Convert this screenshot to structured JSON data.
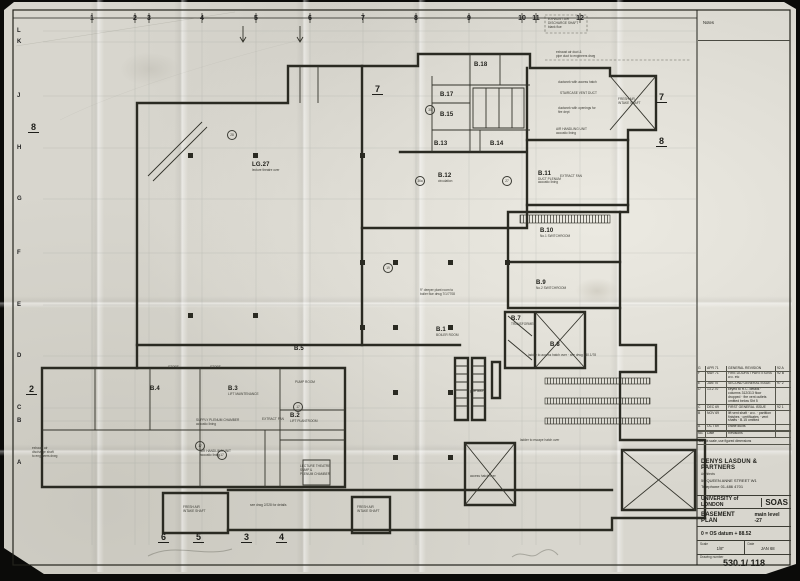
{
  "sheet": {
    "notes_label": "Notes",
    "do_not_scale": "Do not scale, use figured dimensions"
  },
  "grid": {
    "top_numbers": [
      {
        "label": "1",
        "x": 92
      },
      {
        "label": "2",
        "x": 135
      },
      {
        "label": "3",
        "x": 149
      },
      {
        "label": "4",
        "x": 202
      },
      {
        "label": "5",
        "x": 256
      },
      {
        "label": "6",
        "x": 310
      },
      {
        "label": "7",
        "x": 363
      },
      {
        "label": "8",
        "x": 416
      },
      {
        "label": "9",
        "x": 469
      },
      {
        "label": "10",
        "x": 522
      },
      {
        "label": "11",
        "x": 536
      },
      {
        "label": "12",
        "x": 580
      }
    ],
    "left_letters": [
      {
        "label": "L",
        "y": 31
      },
      {
        "label": "K",
        "y": 42
      },
      {
        "label": "J",
        "y": 96
      },
      {
        "label": "H",
        "y": 148
      },
      {
        "label": "G",
        "y": 199
      },
      {
        "label": "F",
        "y": 253
      },
      {
        "label": "E",
        "y": 305
      },
      {
        "label": "D",
        "y": 356
      },
      {
        "label": "C",
        "y": 408
      },
      {
        "label": "B",
        "y": 421
      },
      {
        "label": "A",
        "y": 463
      }
    ]
  },
  "section_markers": [
    {
      "t": "8",
      "x": 28,
      "y": 122
    },
    {
      "t": "2",
      "x": 26,
      "y": 384
    },
    {
      "t": "7",
      "x": 372,
      "y": 84
    },
    {
      "t": "7",
      "x": 656,
      "y": 92
    },
    {
      "t": "8",
      "x": 656,
      "y": 136
    },
    {
      "t": "6",
      "x": 158,
      "y": 532
    },
    {
      "t": "5",
      "x": 193,
      "y": 532
    },
    {
      "t": "3",
      "x": 241,
      "y": 532
    },
    {
      "t": "4",
      "x": 276,
      "y": 532
    }
  ],
  "rooms": [
    {
      "id": "LG.27",
      "sub": "lecture theatre over",
      "x": 252,
      "y": 162
    },
    {
      "id": "B.18",
      "sub": "",
      "x": 474,
      "y": 62
    },
    {
      "id": "B.17",
      "sub": "",
      "x": 440,
      "y": 92
    },
    {
      "id": "B.15",
      "sub": "",
      "x": 440,
      "y": 112
    },
    {
      "id": "B.13",
      "sub": "",
      "x": 434,
      "y": 141
    },
    {
      "id": "B.14",
      "sub": "",
      "x": 490,
      "y": 141
    },
    {
      "id": "B.12",
      "sub": "circulation",
      "x": 438,
      "y": 173
    },
    {
      "id": "B.11",
      "sub": "DUCT PLENUM\nacoustic lining",
      "x": 538,
      "y": 171
    },
    {
      "id": "B.10",
      "sub": "No.1 SWITCHROOM",
      "x": 540,
      "y": 228
    },
    {
      "id": "B.9",
      "sub": "No.2 SWITCHROOM",
      "x": 536,
      "y": 280
    },
    {
      "id": "B.7",
      "sub": "TRANSFORMER",
      "x": 511,
      "y": 316
    },
    {
      "id": "B.8",
      "sub": "",
      "x": 550,
      "y": 342
    },
    {
      "id": "B.5",
      "sub": "",
      "x": 294,
      "y": 346
    },
    {
      "id": "B.4",
      "sub": "",
      "x": 150,
      "y": 386
    },
    {
      "id": "B.3",
      "sub": "LIFT MAINTENANCE",
      "x": 228,
      "y": 386
    },
    {
      "id": "B.2",
      "sub": "LIFT PLANTROOM",
      "x": 290,
      "y": 413
    },
    {
      "id": "B.1",
      "sub": "BOILER ROOM",
      "x": 436,
      "y": 327
    }
  ],
  "annotations": [
    {
      "x": 548,
      "y": 17,
      "t": "EXHAUST AIR\nDISCHARGE SHAFT\nblank flue"
    },
    {
      "x": 556,
      "y": 50,
      "t": "exhaust air duct &\npipe duct to engineers drwg"
    },
    {
      "x": 558,
      "y": 80,
      "t": "ductwork with access hatch"
    },
    {
      "x": 560,
      "y": 91,
      "t": "STAIRCASE  VENT  DUCT"
    },
    {
      "x": 558,
      "y": 106,
      "t": "ductwork with openings for\nfire dept"
    },
    {
      "x": 556,
      "y": 127,
      "t": "AIR HANDLING UNIT\nacoustic lining"
    },
    {
      "x": 618,
      "y": 97,
      "t": "FRESH AIR\nINTAKE SHAFT"
    },
    {
      "x": 560,
      "y": 174,
      "t": "EXTRACT FAN"
    },
    {
      "x": 295,
      "y": 380,
      "t": "PUMP ROOM"
    },
    {
      "x": 262,
      "y": 417,
      "t": "EXTRACT FAN"
    },
    {
      "x": 196,
      "y": 418,
      "t": "SUPPLY PLENUM CHAMBER\nacoustic lining"
    },
    {
      "x": 200,
      "y": 449,
      "t": "AIR HANDLING UNIT\nacoustic lining"
    },
    {
      "x": 300,
      "y": 464,
      "t": "LECTURE THEATRE\nSUMP &\nPLENUM CHAMBER"
    },
    {
      "x": 183,
      "y": 505,
      "t": "FRESH AIR\nINTAKE SHAFT"
    },
    {
      "x": 357,
      "y": 505,
      "t": "FRESH AIR\nINTAKE SHAFT"
    },
    {
      "x": 250,
      "y": 503,
      "t": "see drwg 2/228 for details"
    },
    {
      "x": 520,
      "y": 438,
      "t": "ladder to escape hatch over"
    },
    {
      "x": 528,
      "y": 353,
      "t": "ladder to access hatch over · see drwg 530.1/78"
    },
    {
      "x": 470,
      "y": 474,
      "t": "access hatch over"
    },
    {
      "x": 470,
      "y": 389,
      "t": "pipe duct"
    },
    {
      "x": 32,
      "y": 446,
      "t": "exhaust air\ndischarge shaft\nto engineers drwg"
    },
    {
      "x": 420,
      "y": 288,
      "t": "9\" deeper plant room to\nboiler flue drwg  7/1/7708"
    },
    {
      "x": 168,
      "y": 365,
      "t": "STORE"
    },
    {
      "x": 210,
      "y": 365,
      "t": "STORE"
    }
  ],
  "circle_refs": [
    {
      "x": 232,
      "y": 135,
      "t": "28"
    },
    {
      "x": 420,
      "y": 181,
      "t": "36a"
    },
    {
      "x": 507,
      "y": 181,
      "t": "27"
    },
    {
      "x": 388,
      "y": 268,
      "t": "19"
    },
    {
      "x": 298,
      "y": 407,
      "t": "17"
    },
    {
      "x": 200,
      "y": 446,
      "t": "17"
    },
    {
      "x": 222,
      "y": 455,
      "t": "17"
    },
    {
      "x": 430,
      "y": 110,
      "t": "30"
    }
  ],
  "title_block": {
    "revision_header": {
      "no": "No.",
      "date": "Date",
      "revisions": "Revisions"
    },
    "revisions": [
      {
        "no": "G",
        "date": "APR 71",
        "text": "GENERAL REVISION",
        "ref": "92 A"
      },
      {
        "no": "F",
        "date": "MAY 71",
        "text": "FIRE DOORS / PARTITIONS w.c. etc",
        "ref": "92 B"
      },
      {
        "no": "E",
        "date": "JAN 70",
        "text": "SECOND GENERAL ISSUE",
        "ref": "97 2"
      },
      {
        "no": "D",
        "date": "13.2.70",
        "text": "keyed to R.C. details · columns 312/313 floor dropped · fire vent outlets omitted below Sht 5",
        "ref": ""
      },
      {
        "no": "C",
        "date": "DEC 69",
        "text": "FIRST GENERAL ISSUE",
        "ref": "92 1"
      },
      {
        "no": "B",
        "date": "NOV 69",
        "text": "lift vent shaft · w.c. · partition finishes · certificates · vent shafts · B.15 omitted",
        "ref": ""
      },
      {
        "no": "A",
        "date": "OCT 69",
        "text": "crane ducts",
        "ref": ""
      }
    ],
    "architect": {
      "name": "DENYS LASDUN & PARTNERS",
      "role": "Architects",
      "address": "50 QUEEN ANNE STREET W1",
      "phone": "Telephone 01-486 4701"
    },
    "client": {
      "name": "UNIVERSITY of LONDON",
      "abbrev": "SOAS"
    },
    "drawing_title": {
      "main": "BASEMENT PLAN",
      "sub": "main level -27"
    },
    "datum": "0 = OS datum + 88.52",
    "scale_label": "Scale",
    "scale_value": "1/8\"",
    "date_label": "Date",
    "date_value": "JAN 68",
    "drawing_number_label": "Drawing number",
    "drawing_number": "530.1/ 118"
  }
}
